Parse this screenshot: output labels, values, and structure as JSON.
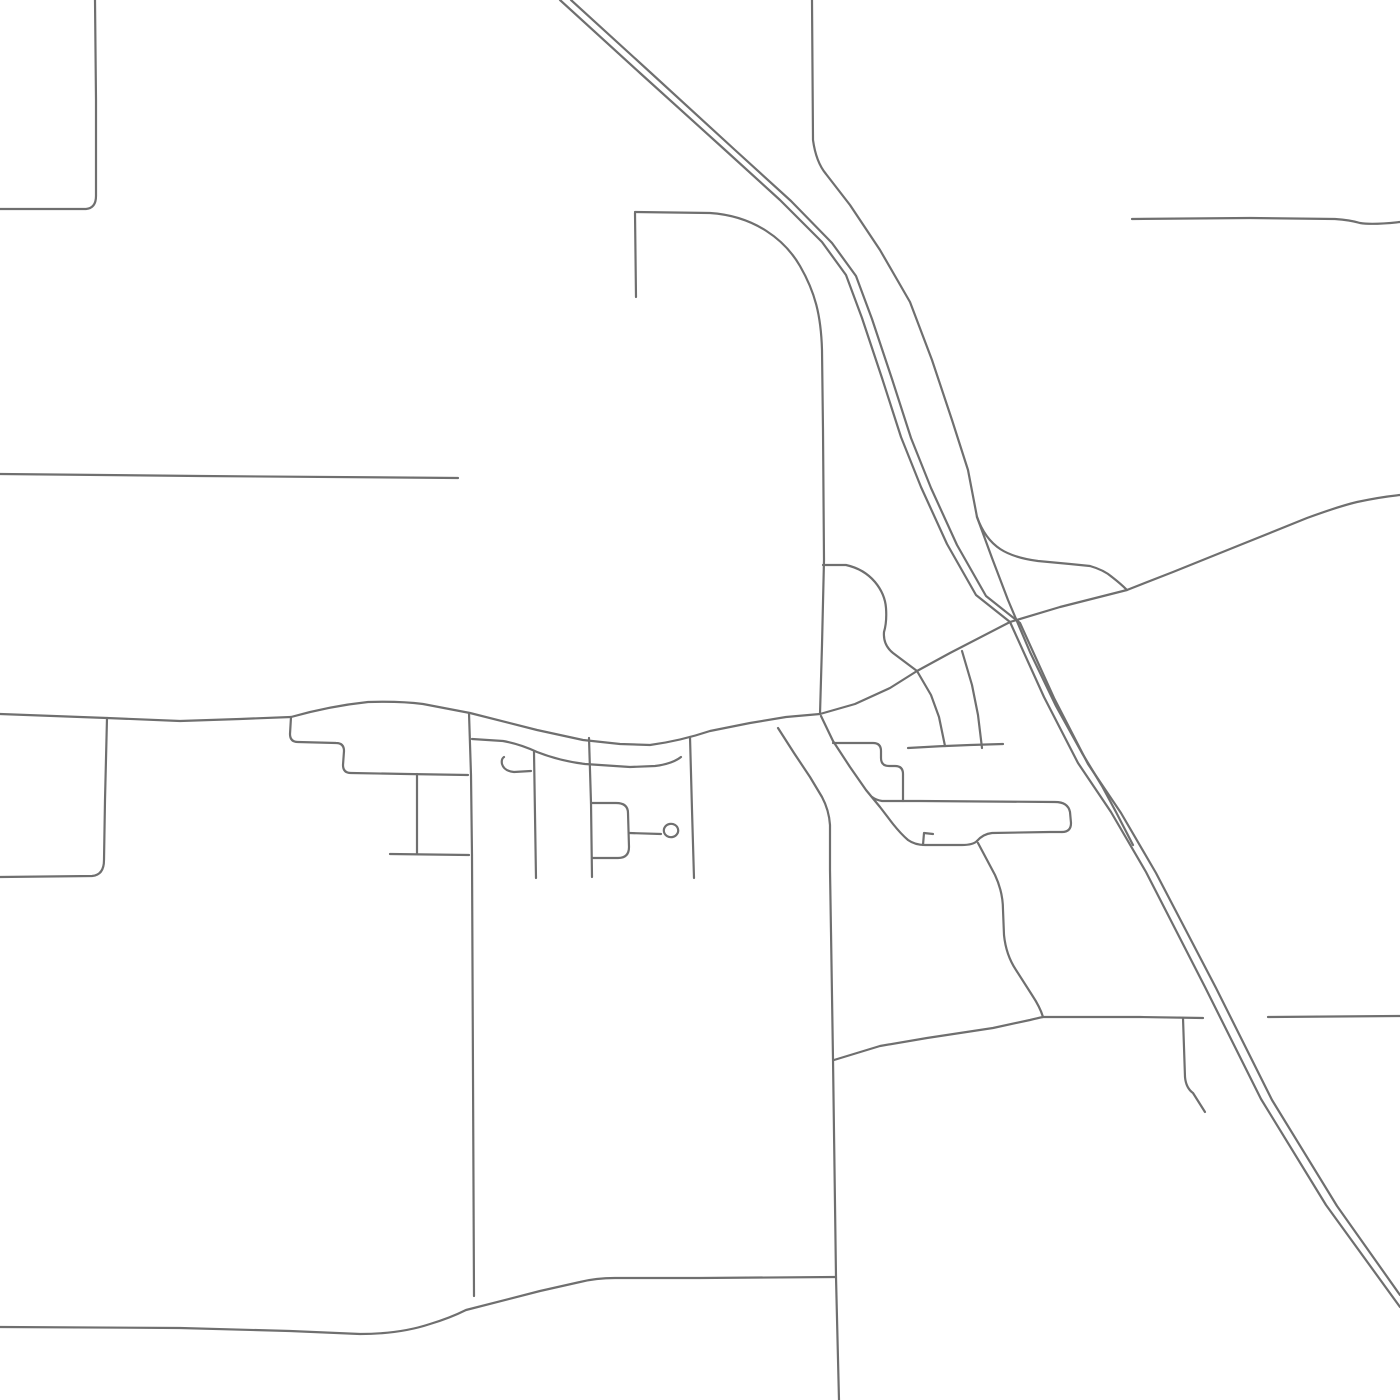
{
  "canvas": {
    "width": 1400,
    "height": 1400,
    "background_color": "#ffffff"
  },
  "style": {
    "road_stroke_color": "#6f6f6f",
    "road_stroke_width": 2.2,
    "linecap": "round",
    "linejoin": "round"
  },
  "map": {
    "kind": "street-map-line-art",
    "labels": [],
    "roads": [
      {
        "id": "topleft-l-road",
        "kind": "street",
        "d": "M 0 209 L 86 209 Q 96 208 96 196 L 96 100 L 95 0"
      },
      {
        "id": "west-road",
        "kind": "street",
        "d": "M 0 474 L 200 476 L 458 478"
      },
      {
        "id": "main-ew-road-and-ne-diagonal",
        "kind": "major-road",
        "d": "M 0 714 L 107 718 L 180 721 L 240 719 L 291 717 Q 330 706 368 702 Q 400 701 423 704 L 470 713 L 537 730 L 583 740 L 620 744 L 650 745 Q 680 741 710 731 L 750 723 L 786 717 L 820 714 L 855 704 L 890 688 L 917 671 L 950 653 L 1010 622 L 1060 607 L 1127 590 L 1173 572 L 1240 545 L 1307 518 Q 1340 506 1357 502 Q 1380 497 1400 495"
      },
      {
        "id": "fork-lower-block-road",
        "kind": "street",
        "d": "M 291 717 L 290 734 Q 290 742 298 742 L 336 743 Q 344 743 344 751 L 343 765 Q 343 773 351 773 L 407 774 L 468 775"
      },
      {
        "id": "vertical-x107",
        "kind": "street",
        "d": "M 107 718 L 105 800 L 104 860 Q 104 875 92 876 L 0 877"
      },
      {
        "id": "vertical-x470-long",
        "kind": "street",
        "d": "M 469 713 L 471 775 L 472 855 L 474 1296"
      },
      {
        "id": "service-road-u2",
        "kind": "street",
        "d": "M 472 739 L 503 741 Q 520 744 537 752 Q 560 761 585 764 L 630 767 L 655 766 Q 672 764 681 757"
      },
      {
        "id": "small-hook",
        "kind": "street",
        "d": "M 531 771 L 514 772 Q 504 771 502 764 Q 501 759 504 757"
      },
      {
        "id": "vertical-x534",
        "kind": "street",
        "d": "M 534 752 L 536 878"
      },
      {
        "id": "vertical-x591",
        "kind": "street",
        "d": "M 589 738 L 591 803 L 592 877"
      },
      {
        "id": "rounded-block",
        "kind": "street",
        "d": "M 591 803 L 616 803 Q 628 803 628 813 L 629 847 Q 629 858 618 858 L 592 858"
      },
      {
        "id": "culdesac-stem",
        "kind": "street",
        "d": "M 629 833 L 661 834"
      },
      {
        "id": "culdesac-loop",
        "kind": "street",
        "d": "M 664 832 a 7 6.5 0 1 0 14 -3 a 7 6.5 0 1 0 -14 3"
      },
      {
        "id": "vertical-x691",
        "kind": "street",
        "d": "M 690 737 L 692 810 L 694 878"
      },
      {
        "id": "y854-road",
        "kind": "street",
        "d": "M 390 854 L 469 855"
      },
      {
        "id": "vertical-x417",
        "kind": "street",
        "d": "M 417 774 L 417 854"
      },
      {
        "id": "top-center-stub",
        "kind": "street",
        "d": "M 635 213 L 636 297"
      },
      {
        "id": "top-center-curve-to-vertical",
        "kind": "major-road",
        "d": "M 635 212 L 710 213 C 755 216 785 240 800 266 C 815 292 821 315 822 350 L 823 430 L 824 560 L 822 645 L 820 714"
      },
      {
        "id": "highway-west-line",
        "kind": "highway",
        "d": "M 560 0 L 640 73 L 724 149 L 780 200 L 822 242 L 846 275 L 862 318 L 882 378 L 901 437 L 921 487 L 947 544 L 976 595 L 1010 622 L 1044 697 L 1078 763 L 1111 812 L 1146 872 L 1205 987 L 1261 1099 L 1326 1205 L 1400 1307"
      },
      {
        "id": "highway-east-line",
        "kind": "highway",
        "d": "M 571 0 L 651 73 L 735 150 L 791 201 L 832 243 L 856 276 L 872 319 L 892 379 L 911 438 L 931 488 L 957 545 L 986 596 L 1020 623 L 1054 698 L 1088 764 L 1121 813 L 1156 873 L 1216 988 L 1272 1100 L 1337 1206 L 1400 1295"
      },
      {
        "id": "frontage-north",
        "kind": "ramp",
        "d": "M 812 0 L 813 140 Q 816 162 826 174 L 850 205 L 880 250 L 910 302 L 932 360 L 952 420 L 968 470 L 977 517"
      },
      {
        "id": "frontage-east-connector",
        "kind": "ramp",
        "d": "M 977 517 C 988 548 1008 557 1038 561 L 1070 564 L 1090 566 Q 1104 570 1112 577 Q 1121 584 1127 590"
      },
      {
        "id": "frontage-south-leg",
        "kind": "ramp",
        "d": "M 977 517 L 992 558 L 1008 600 L 1030 652 L 1056 706 L 1082 753 L 1102 786 L 1116 812 L 1133 845"
      },
      {
        "id": "west-frontage-wavy",
        "kind": "ramp",
        "d": "M 823 565 L 846 565 Q 864 569 875 582 Q 885 594 886 608 Q 887 622 884 632 Q 883 645 893 653 L 917 671 L 931 695 L 939 717 L 945 746"
      },
      {
        "id": "ramp-from-diagonal",
        "kind": "ramp",
        "d": "M 962 651 L 972 685 L 978 715 L 982 748"
      },
      {
        "id": "y744-road",
        "kind": "street",
        "d": "M 908 748 Q 940 746 970 745 L 1003 744"
      },
      {
        "id": "stepped-road",
        "kind": "street",
        "d": "M 833 743 L 873 743 Q 881 743 881 751 L 881 758 Q 881 766 889 766 L 895 766 Q 903 766 903 774 L 903 801"
      },
      {
        "id": "se-diagonal-to-steps",
        "kind": "street",
        "d": "M 821 716 L 833 741 L 850 767 L 866 790 L 880 807 L 893 824 Q 901 834 908 840 Q 915 845 925 845 L 962 845 Q 973 845 977 841"
      },
      {
        "id": "block-row-h2",
        "kind": "street",
        "d": "M 977 841 Q 983 834 992 833 L 1050 832 L 1062 832"
      },
      {
        "id": "block-lasso-h1",
        "kind": "street",
        "d": "M 872 797 Q 876 800 882 801 L 920 801 L 1055 802 Q 1068 802 1070 812 L 1071 823 Q 1071 832 1062 832"
      },
      {
        "id": "south-connector-s2",
        "kind": "street",
        "d": "M 978 843 L 995 875 Q 1003 892 1003 910 L 1004 935 Q 1006 955 1016 970 L 1032 995 Q 1040 1007 1043 1017"
      },
      {
        "id": "tiny-tick",
        "kind": "street",
        "d": "M 933 834 L 924 833 L 923 845"
      },
      {
        "id": "south-road-long",
        "kind": "major-road",
        "d": "M 778 728 L 794 753 L 810 777 L 822 797 Q 829 810 830 825 L 830 870 L 831 932 L 833 1059 L 836 1277 L 839 1400"
      },
      {
        "id": "bottom-road",
        "kind": "street",
        "d": "M 0 1327 L 180 1328 L 290 1331 L 360 1334 Q 400 1334 430 1324 Q 450 1318 466 1310 L 540 1291 L 580 1282 Q 596 1278 615 1278 L 700 1278 L 836 1277"
      },
      {
        "id": "southeast-road-west-of-highway",
        "kind": "street",
        "d": "M 834 1060 L 880 1046 L 927 1038 L 993 1028 L 1030 1020 Q 1038 1018 1043 1017 L 1140 1017 L 1203 1018"
      },
      {
        "id": "southeast-road-east-of-highway",
        "kind": "street",
        "d": "M 1268 1017 L 1400 1016"
      },
      {
        "id": "southeast-hook",
        "kind": "street",
        "d": "M 1183 1018 L 1185 1077 Q 1186 1088 1193 1093 L 1205 1112"
      },
      {
        "id": "topright-road",
        "kind": "street",
        "d": "M 1132 219 L 1250 218 L 1335 219 Q 1350 220 1360 223 Q 1372 225 1400 222"
      }
    ]
  }
}
